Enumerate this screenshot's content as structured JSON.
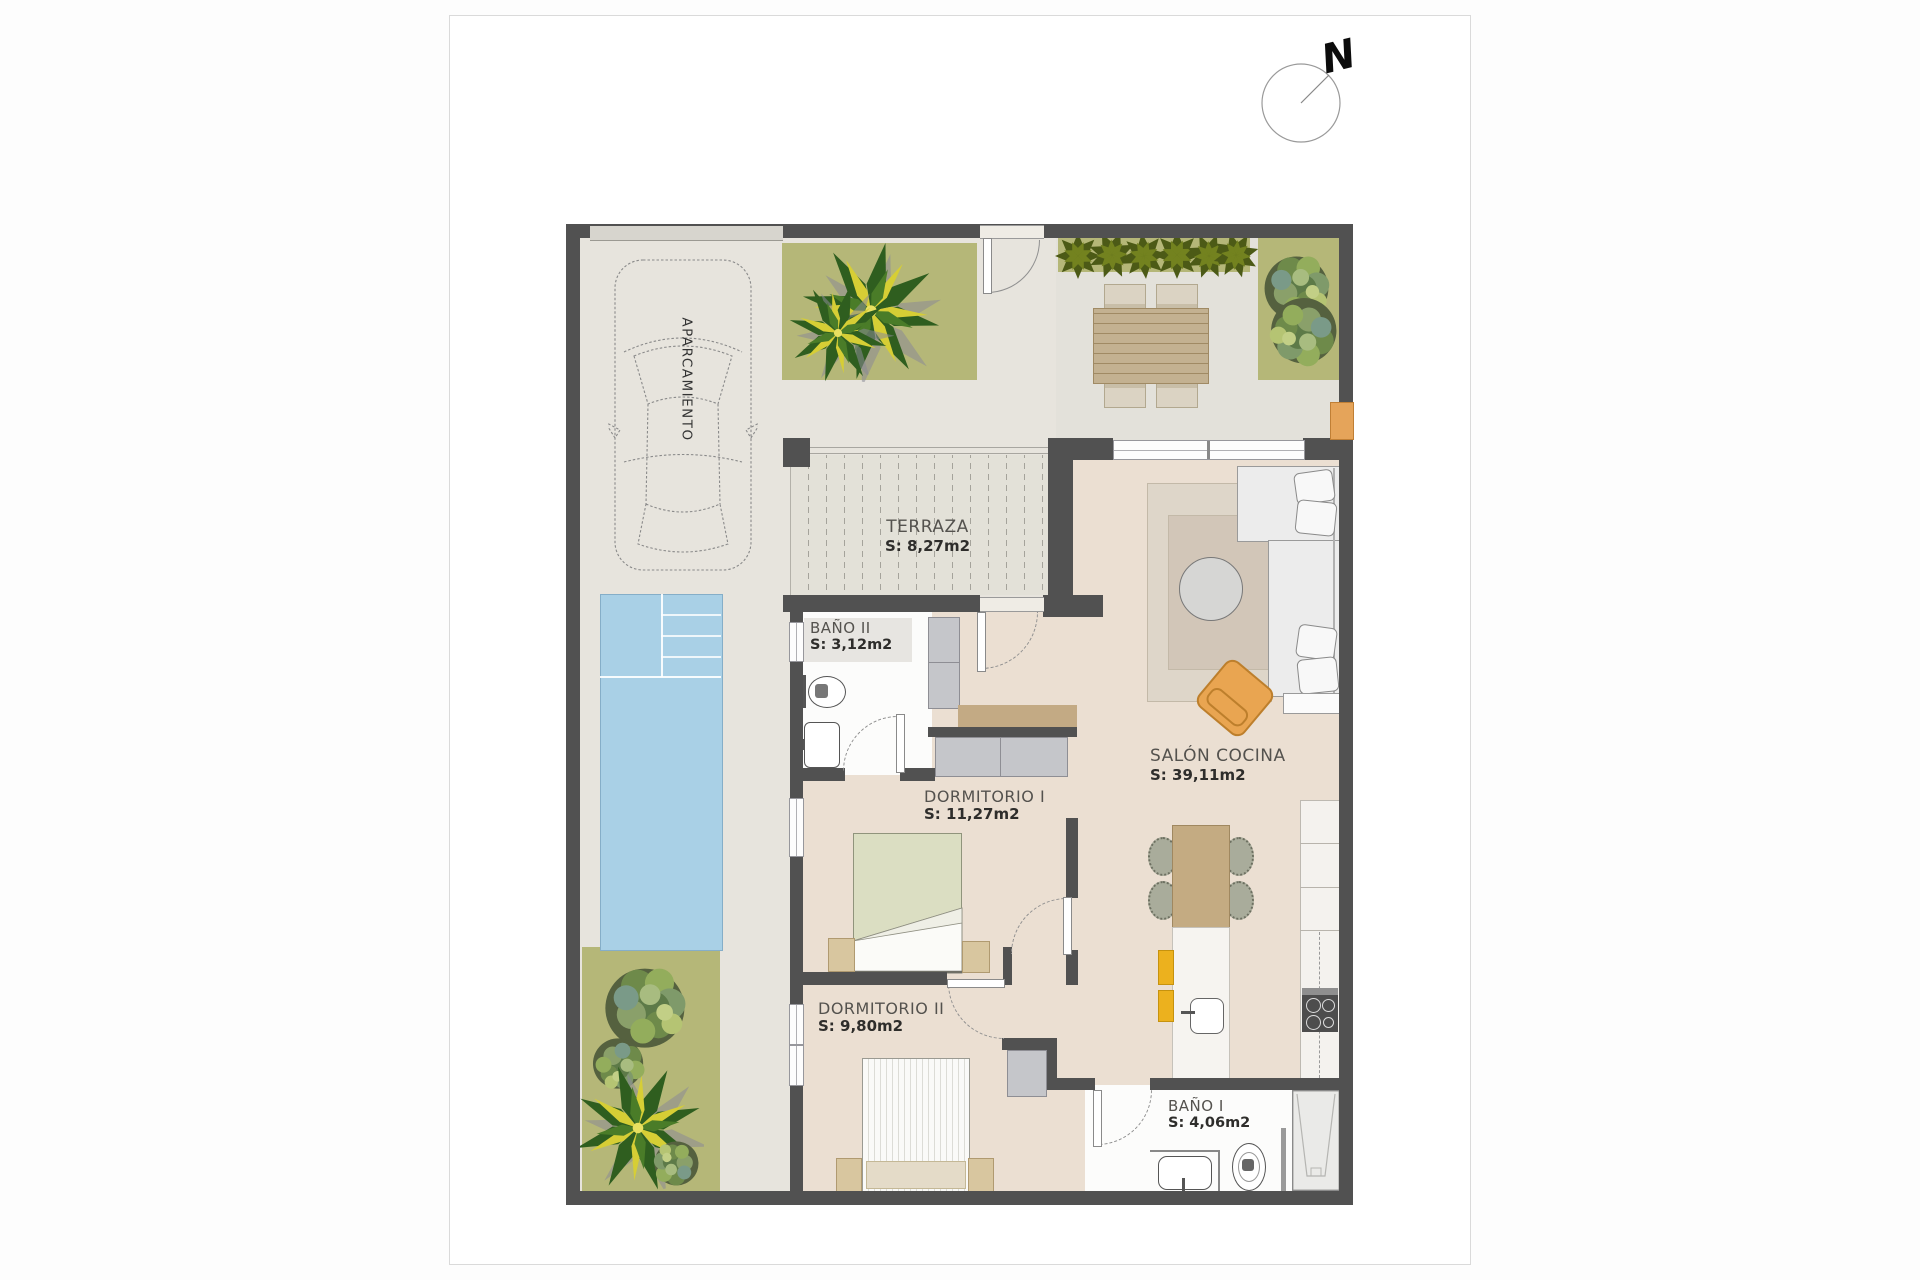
{
  "plan": {
    "compass_label": "N",
    "parking_label": "APARCAMIENTO",
    "rooms": [
      {
        "name": "TERRAZA",
        "area": "S: 8,27m2"
      },
      {
        "name": "BAÑO II",
        "area": "S: 3,12m2"
      },
      {
        "name": "DORMITORIO I",
        "area": "S: 11,27m2"
      },
      {
        "name": "SALÓN COCINA",
        "area": "S: 39,11m2"
      },
      {
        "name": "DORMITORIO II",
        "area": "S: 9,80m2"
      },
      {
        "name": "BAÑO I",
        "area": "S: 4,06m2"
      }
    ],
    "colors": {
      "wall": "#515151",
      "interior_floor": "#ebdfd2",
      "outdoor_floor": "#e7e4dd",
      "deck_floor": "#e3e1d8",
      "pool": "#a9d0e6",
      "planter": "#b5b778",
      "accent_orange": "#e5a45a",
      "accent_yellow": "#ecb11e",
      "wood": "#c3aa82"
    }
  }
}
